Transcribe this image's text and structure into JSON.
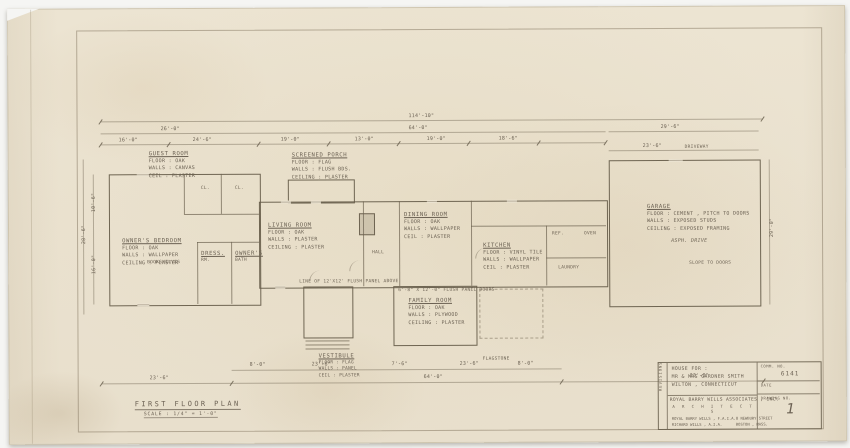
{
  "sheet": {
    "plan_title": "FIRST FLOOR PLAN",
    "plan_scale": "SCALE : 1/4\" = 1'-0\""
  },
  "title_block": {
    "revision_strip": "REVISIONS",
    "project_lines": [
      "HOUSE FOR :",
      "MR & MRS GARDNER SMITH",
      "WILTON , CONNECTICUT"
    ],
    "firm_name": "ROYAL BARRY WILLS ASSOCIATES , INC.",
    "architects": "A R C H I T E C T S",
    "firm_small_left": [
      "ROYAL BARRY WILLS , F.A.I.A.",
      "RICHARD WILLS , A.I.A."
    ],
    "firm_small_right": [
      "8 NEWBURY STREET",
      "BOSTON , MASS."
    ],
    "comm_no_label": "COMM. NO.",
    "comm_no_value": "6141",
    "date_label": "DATE",
    "drawing_no_label": "DRAWING NO.",
    "drawing_no_value": "1"
  },
  "rooms": {
    "guest": [
      "GUEST ROOM",
      "FLOOR : OAK",
      "WALLS : CANVAS",
      "CEIL : PLASTER"
    ],
    "owners": [
      "OWNER'S BEDROOM",
      "FLOOR : OAK",
      "WALLS : WALLPAPER",
      "CEILING : PLASTER"
    ],
    "dress": [
      "DRESS.",
      "RM."
    ],
    "bath": [
      "OWNER'S",
      "BATH"
    ],
    "porch": [
      "SCREENED PORCH",
      "FLOOR : FLAG",
      "WALLS : FLUSH BDS.",
      "CEILING : PLASTER"
    ],
    "living": [
      "LIVING ROOM",
      "FLOOR : OAK",
      "WALLS : PLASTER",
      "CEILING : PLASTER"
    ],
    "dining": [
      "DINING ROOM",
      "FLOOR : OAK",
      "WALLS : WALLPAPER",
      "CEIL : PLASTER"
    ],
    "kitchen": [
      "KITCHEN",
      "FLOOR : VINYL TILE",
      "WALLS : WALLPAPER",
      "CEIL : PLASTER"
    ],
    "family": [
      "FAMILY ROOM",
      "FLOOR : OAK",
      "WALLS : PLYWOOD",
      "CEILING : PLASTER"
    ],
    "vestibule": [
      "VESTIBULE",
      "FLOOR : FLAG",
      "WALLS : PANEL",
      "CEIL : PLASTER"
    ],
    "garage": [
      "GARAGE",
      "FLOOR : CEMENT , PITCH TO DOORS",
      "WALLS : EXPOSED STUDS",
      "CEILING : EXPOSED FRAMING"
    ]
  },
  "notes": {
    "bookshelves": "BOOKSHELVES",
    "closet": "CL.",
    "closet2": "CL.",
    "hall": "HALL",
    "ref": "REF.",
    "oven": "OVEN",
    "laundry": "LAUNDRY",
    "flagstone": "FLAGSTONE",
    "living_note": "LINE OF 12'X12' FLUSH PANEL ABOVE",
    "family_note": "6'-8\" X 12'-0\" FLUSH PANEL DOORS",
    "asph_drive": "ASPH. DRIVE",
    "slope": "SLOPE TO DOORS",
    "driveway": "DRIVEWAY"
  },
  "dims": {
    "overall_top": "114'-10\"",
    "top_left_seg": "26'-0\"",
    "top_mid_seg": "64'-0\"",
    "garage_top": "29'-6\"",
    "garage_top2": "23'-6\"",
    "seg_a": "16'-0\"",
    "seg_b": "24'-6\"",
    "seg_c": "19'-0\"",
    "seg_d": "13'-0\"",
    "seg_e": "19'-0\"",
    "seg_f": "18'-6\"",
    "bot_a": "8'-0\"",
    "bot_b": "23'-6\"",
    "bot_c": "7'-6\"",
    "bot_d": "23'-6\"",
    "bot_e": "8'-0\"",
    "bot_left": "23'-6\"",
    "bot_mid": "64'-0\"",
    "bot_right": "33'-0\"",
    "left_v1": "10'-6\"",
    "left_v2": "16'-0\"",
    "left_v_all": "28'-6\"",
    "right_v": "29'-0\""
  }
}
